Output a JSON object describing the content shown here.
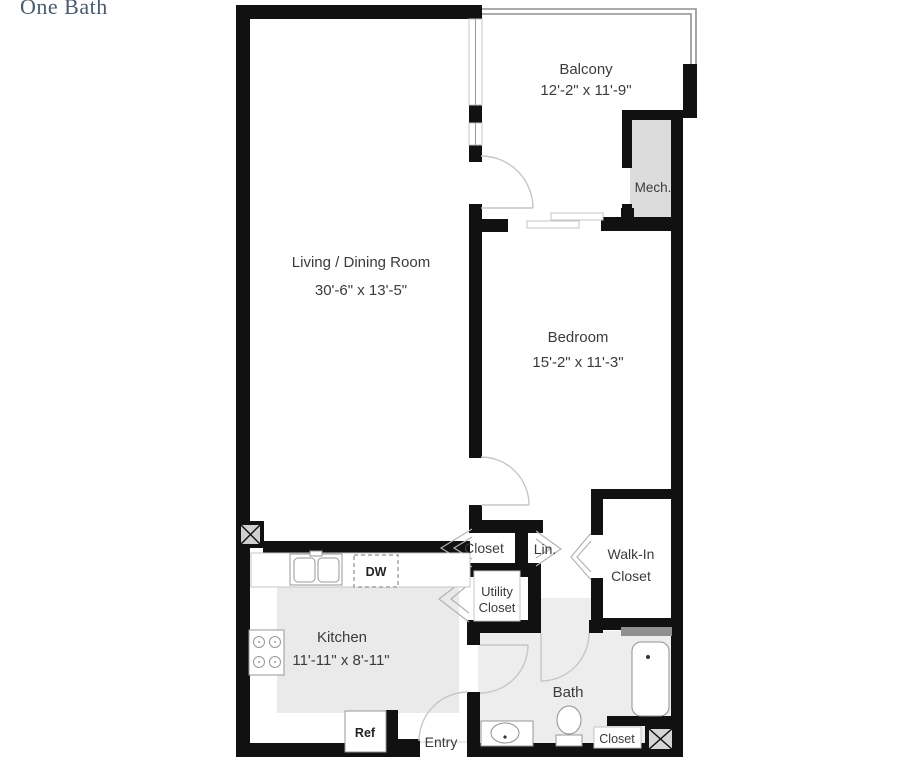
{
  "page": {
    "title": "One Bath"
  },
  "rooms": {
    "living": {
      "name": "Living / Dining Room",
      "dims": "30'-6\" x 13'-5\""
    },
    "balcony": {
      "name": "Balcony",
      "dims": "12'-2\" x 11'-9\""
    },
    "bedroom": {
      "name": "Bedroom",
      "dims": "15'-2\" x 11'-3\""
    },
    "kitchen": {
      "name": "Kitchen",
      "dims": "11'-11\" x 8'-11\""
    },
    "bath": {
      "name": "Bath"
    },
    "walk_in_closet": {
      "line1": "Walk-In",
      "line2": "Closet"
    },
    "utility_closet": {
      "line1": "Utility",
      "line2": "Closet"
    },
    "closet": {
      "name": "Closet"
    },
    "linen": {
      "name": "Lin."
    },
    "bath_closet": {
      "name": "Closet"
    },
    "mech": {
      "name": "Mech."
    },
    "entry": {
      "name": "Entry"
    }
  },
  "appliances": {
    "dishwasher": "DW",
    "refrigerator": "Ref"
  },
  "colors": {
    "wall": "#111111",
    "floor_bath": "#ededed",
    "floor_kitchen": "#eaeaea",
    "floor_mech": "#dcdcdc",
    "door_arc": "#c6c6c6",
    "title_text": "#4a5b6e",
    "label_text": "#3b3b3b",
    "vent_bar": "#8f8f8f"
  }
}
